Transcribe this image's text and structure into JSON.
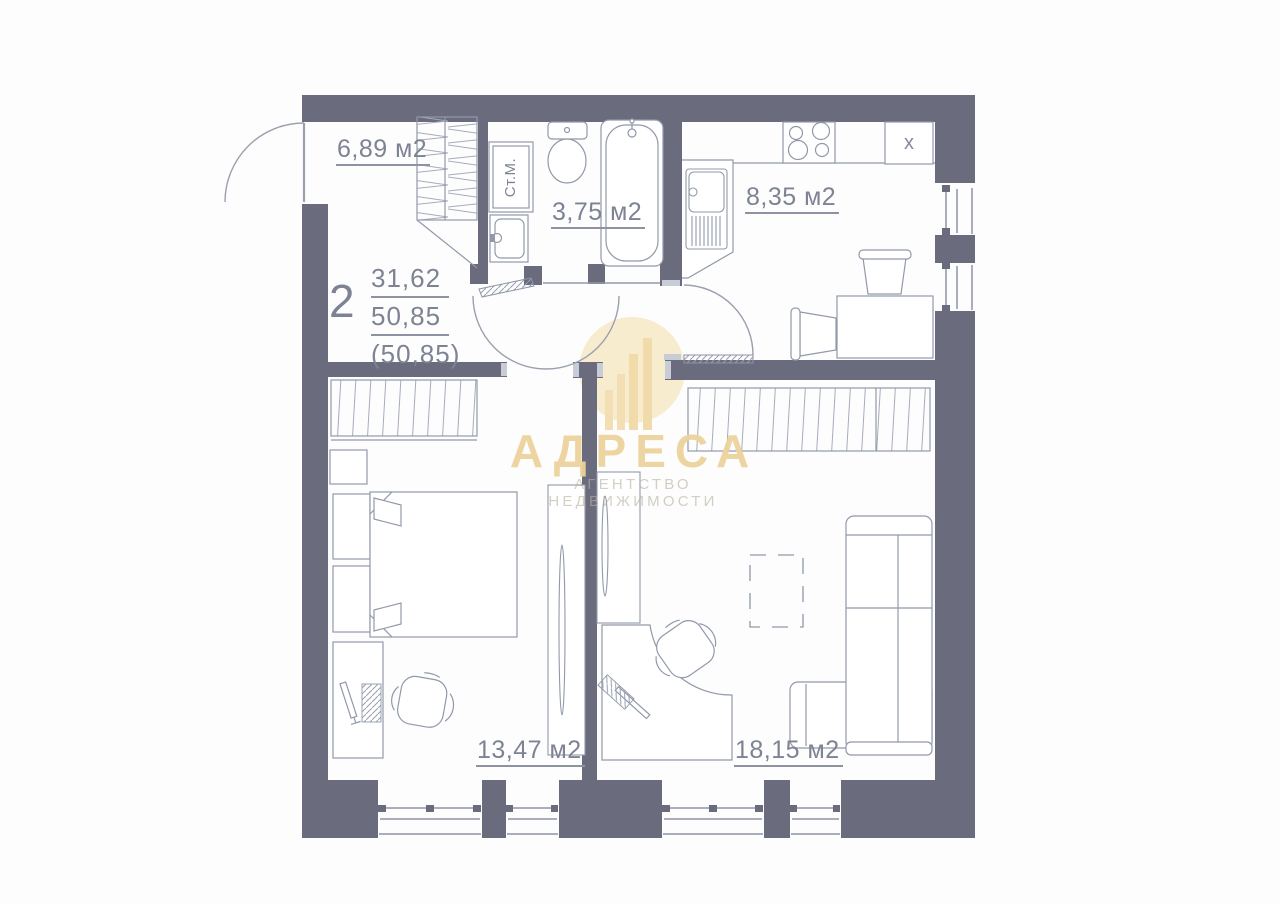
{
  "apartment": {
    "rooms_count": "2",
    "area_living": "31,62",
    "area_total": "50,85",
    "area_total_note": "(50,85)"
  },
  "rooms": {
    "hallway": "6,89 м2",
    "bathroom": "3,75 м2",
    "kitchen": "8,35 м2",
    "bedroom": "13,47 м2",
    "living_room": "18,15 м2"
  },
  "fixtures": {
    "washing_machine": "Ст.М.",
    "kitchen_cabinet": "x"
  },
  "watermark": {
    "brand": "АДРЕСА",
    "tagline": "АГЕНТСТВО НЕДВИЖИМОСТИ"
  },
  "colors": {
    "wall": "#6a6b7d",
    "furniture_line": "#9199a9",
    "label_text": "#7d8393",
    "watermark_gold": "#ecd39c",
    "watermark_tagline": "#bab29e"
  }
}
